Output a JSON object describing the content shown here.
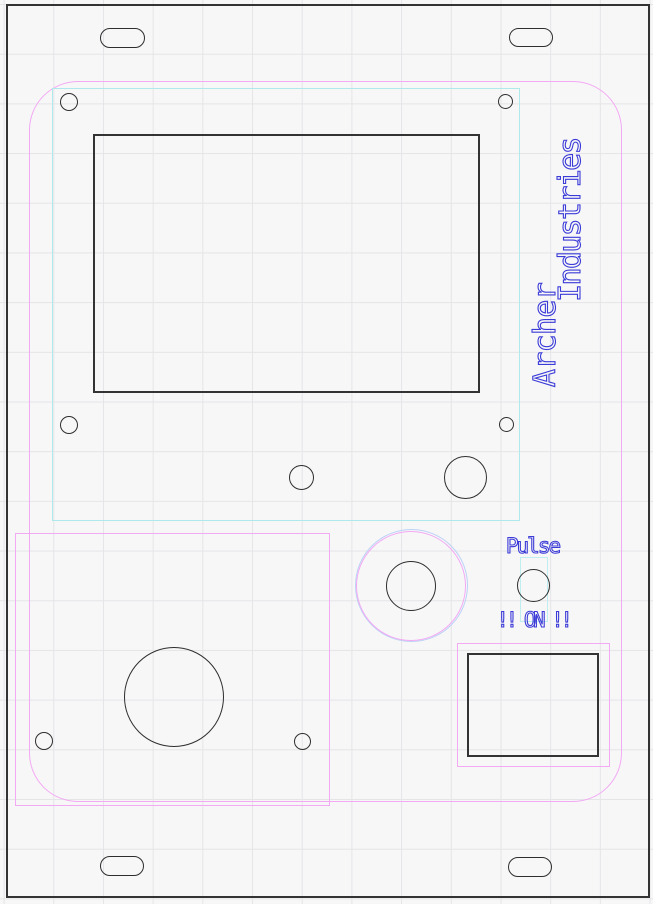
{
  "canvas": {
    "type": "cad-panel-drawing",
    "background": "#f7f7f8",
    "grid_color": "#e5e5e8",
    "grid_spacing_px": 49.7
  },
  "colors": {
    "cut_outline": "#2e2e2e",
    "engrave_blue": "#3b3bd8",
    "overlay_pink": "#f3a9f3",
    "overlay_cyan": "#aeeaec",
    "ring_blue": "#bcd2f5"
  },
  "labels": {
    "brand_line1": "Archer",
    "brand_line2": "Industries",
    "pulse": "Pulse",
    "on_warning": "!! ON !!"
  },
  "features": [
    {
      "name": "panel-outline",
      "type": "rectangle",
      "stroke": "black"
    },
    {
      "name": "mounting-slot",
      "type": "slot",
      "count": 4,
      "stroke": "black"
    },
    {
      "name": "engrave-border",
      "type": "rounded-rectangle",
      "stroke": "pink"
    },
    {
      "name": "display-zone",
      "type": "rectangle",
      "stroke": "cyan"
    },
    {
      "name": "display-cutout",
      "type": "rectangle",
      "stroke": "black"
    },
    {
      "name": "screw-hole",
      "type": "circle",
      "count": 8,
      "stroke": "black"
    },
    {
      "name": "knob-hole-with-rings",
      "type": "circle",
      "stroke": "black, pink, blue"
    },
    {
      "name": "pulse-button-hole",
      "type": "circle",
      "stroke": "black"
    },
    {
      "name": "pulse-zone",
      "type": "rectangle",
      "stroke": "cyan"
    },
    {
      "name": "speaker-area",
      "type": "rectangle",
      "stroke": "pink"
    },
    {
      "name": "speaker-hole",
      "type": "circle",
      "stroke": "black"
    },
    {
      "name": "connector-area",
      "type": "rectangle",
      "stroke": "pink"
    },
    {
      "name": "connector-cutout",
      "type": "rectangle",
      "stroke": "black"
    }
  ]
}
